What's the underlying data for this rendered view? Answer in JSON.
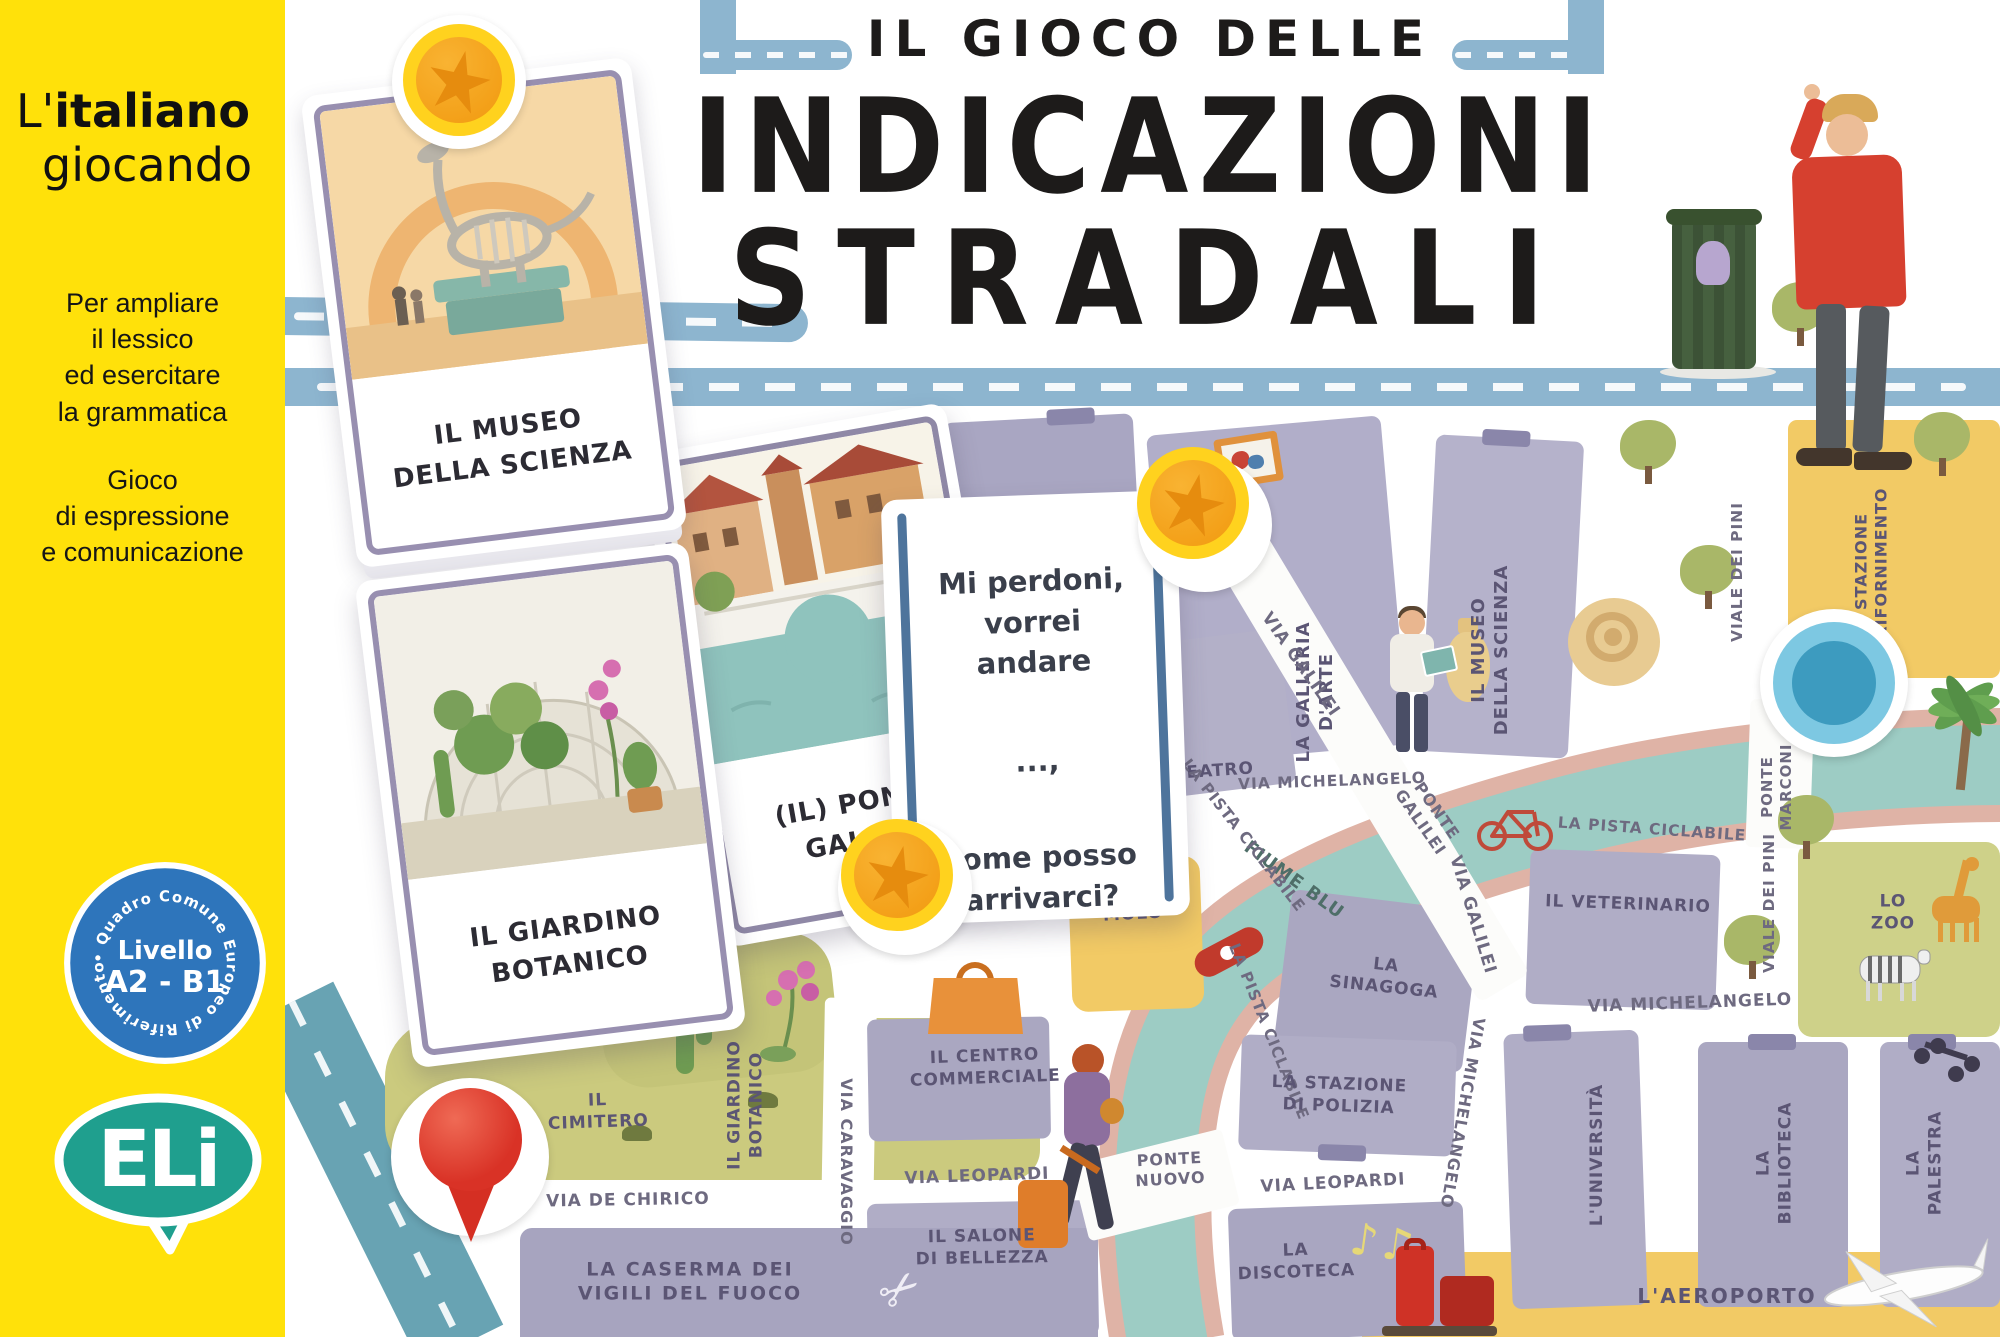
{
  "page": {
    "bg": "#ffffff"
  },
  "sidebar": {
    "bg": "#ffe10a",
    "brand": {
      "prefix": "L'",
      "bold": "italiano",
      "line2": "giocando"
    },
    "tagline1": [
      "Per ampliare",
      "il lessico",
      "ed esercitare",
      "la grammatica"
    ],
    "tagline2": [
      "Gioco",
      "di espressione",
      "e comunicazione"
    ],
    "badge": {
      "ring_text": "• Quadro Comune Europeo di Riferimento",
      "level_label": "Livello",
      "level_value": "A2 - B1",
      "bg": "#2e75bb",
      "star_color": "#ffd500"
    },
    "logo": {
      "text": "ELi",
      "color": "#1f9f8e"
    }
  },
  "header": {
    "kicker": "IL GIOCO DELLE",
    "title1": "INDICAZIONI",
    "title2": "STRADALI"
  },
  "cards": {
    "museum": {
      "label": [
        "IL MUSEO",
        "DELLA SCIENZA"
      ]
    },
    "garden": {
      "label": [
        "IL GIARDINO",
        "BOTANICO"
      ]
    },
    "bridge": {
      "label": [
        "(IL) PONTE",
        "GALILEI"
      ]
    },
    "question": {
      "lines": [
        "Mi perdoni,",
        "vorrei andare",
        "...,",
        "come posso",
        "arrivarci?"
      ]
    }
  },
  "map": {
    "labels": {
      "museo_archeologico": [
        "IL MUSEO",
        "ARCHEOLOGICO"
      ],
      "galleria_arte": [
        "LA GALLERIA",
        "D'ARTE"
      ],
      "museo_scienza": [
        "IL MUSEO",
        "DELLA SCIENZA"
      ],
      "viale_pini": "VIALE DEI PINI",
      "stazione_rifornimento": [
        "LA STAZIONE",
        "DI RIFORNIMENTO"
      ],
      "via_galilei": "VIA GALILEI",
      "ponte_galilei": [
        "PONTE",
        "GALILEI"
      ],
      "teatro": "TEATRO",
      "fiume_blu": "FIUME BLU",
      "pista_ciclabile": "LA PISTA CICLABILE",
      "molo": "MOLO",
      "veterinario": "IL VETERINARIO",
      "sinagoga": [
        "LA",
        "SINAGOGA"
      ],
      "ponte_marconi": [
        "PONTE",
        "MARCONI"
      ],
      "zoo": [
        "LO",
        "ZOO"
      ],
      "via_michelangelo": "VIA MICHELANGELO",
      "centro_commerciale": [
        "IL CENTRO",
        "COMMERCIALE"
      ],
      "stazione_polizia": [
        "LA STAZIONE",
        "DI POLIZIA"
      ],
      "via_leopardi": "VIA LEOPARDI",
      "ponte_nuovo": [
        "PONTE",
        "NUOVO"
      ],
      "salone_bellezza": [
        "IL SALONE",
        "DI BELLEZZA"
      ],
      "discoteca": [
        "LA",
        "DISCOTECA"
      ],
      "universita": "L'UNIVERSITÀ",
      "biblioteca": [
        "LA",
        "BIBLIOTECA"
      ],
      "palestra": [
        "LA",
        "PALESTRA"
      ],
      "aeroporto": "L'AEROPORTO",
      "cimitero": [
        "IL",
        "CIMITERO"
      ],
      "giardino_botanico": [
        "IL GIARDINO",
        "BOTANICO"
      ],
      "via_caravaggio": "VIA CARAVAGGIO",
      "via_de_chirico": "VIA DE CHIRICO",
      "caserma": [
        "LA CASERMA DEI",
        "VIGILI DEL FUOCO"
      ]
    },
    "colors": {
      "river": "#9dccc4",
      "bike_path": "#dfb3a6",
      "road": "#8db5cf",
      "building": "#aeabc7",
      "park_green": "#cbca7e",
      "zone_yellow": "#f2ca65",
      "coin_gold": "#ffd21e",
      "token_blue": "#3d9bbf",
      "pin_red": "#d93226"
    }
  },
  "icons": {
    "star": "★",
    "scissors": "✂",
    "music_notes": "♪♫"
  }
}
